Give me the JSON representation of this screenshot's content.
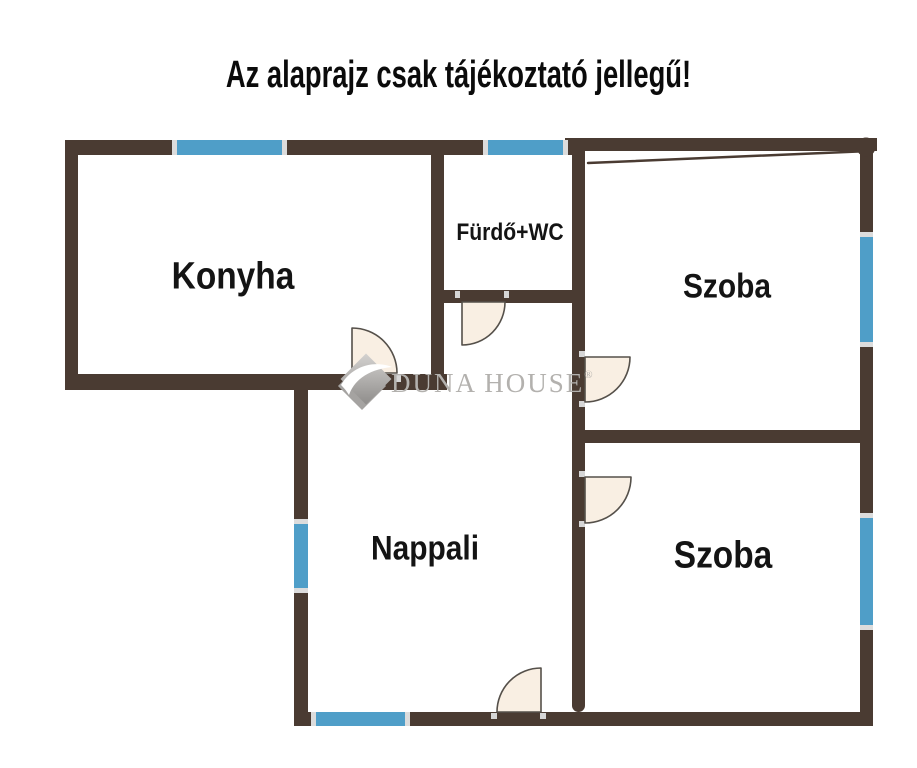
{
  "title": "Az alaprajz csak tájékoztató jellegű!",
  "floorplan": {
    "rooms": {
      "konyha": {
        "label": "Konyha"
      },
      "furdo_wc": {
        "label": "Fürdő+WC"
      },
      "szoba_top": {
        "label": "Szoba"
      },
      "nappali": {
        "label": "Nappali"
      },
      "szoba_bottom": {
        "label": "Szoba"
      }
    },
    "windows_count": 6,
    "doors_count": 5
  },
  "watermark": {
    "display": "DUNA HOUSE",
    "registered": "®"
  },
  "colors": {
    "wall": "#4a3b32",
    "window_blue": "#4f9ec8",
    "window_cap": "#dcdcdc",
    "door_fill": "#f9efe3",
    "door_stroke": "#55504a",
    "label_text": "#141414",
    "watermark_gray": "#b3b1ae"
  }
}
